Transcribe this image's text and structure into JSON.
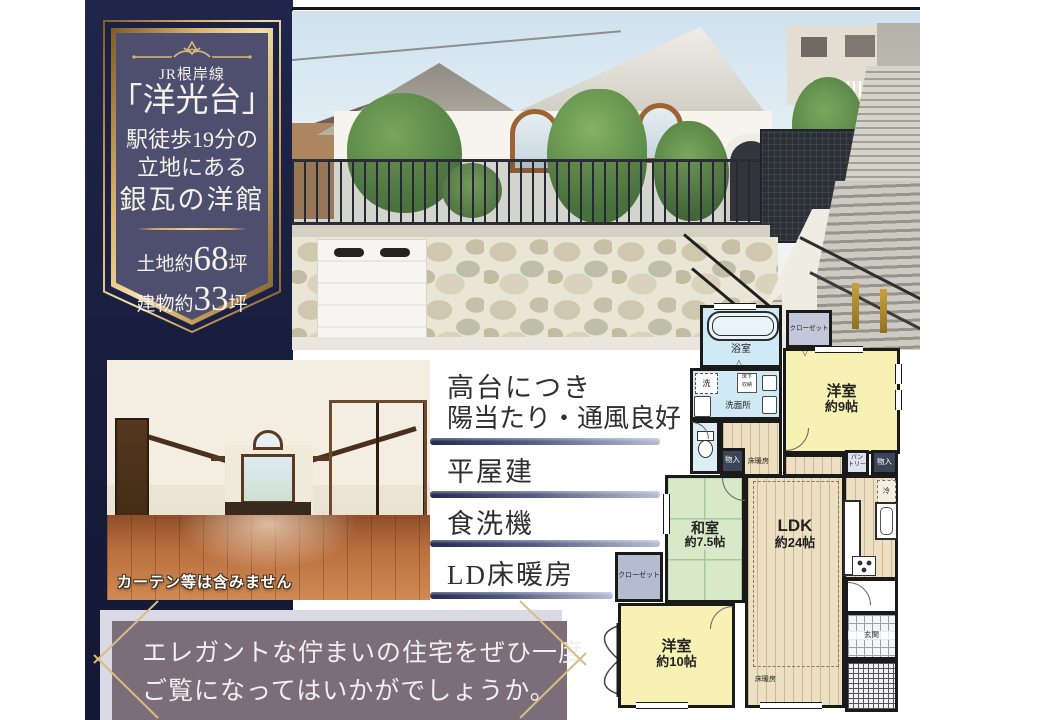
{
  "sidebar": {
    "rail": "JR根岸線",
    "station": "「洋光台」",
    "walk1": "駅徒歩19分の",
    "walk2": "立地にある",
    "catch": "銀瓦の洋館",
    "land_prefix": "土地約",
    "land_value": "68",
    "land_unit": "坪",
    "bldg_prefix": "建物約",
    "bldg_value": "33",
    "bldg_unit": "坪"
  },
  "features": {
    "item1_line1": "高台につき",
    "item1_line2": "陽当たり・通風良好",
    "item2": "平屋建",
    "item3": "食洗機",
    "item4": "LD床暖房"
  },
  "interior": {
    "caption": "カーテン等は含みません"
  },
  "message": {
    "line1": "エレガントな佇まいの住宅をぜひ一度",
    "line2": "ご覧になってはいかがでしょうか。"
  },
  "plan": {
    "bath": "浴室",
    "closet_top": "クローゼット",
    "west9_name": "洋室",
    "west9_size": "約9帖",
    "washroom": "洗面所",
    "washer": "洗",
    "underfloor1": "床下",
    "underfloor2": "収納",
    "storage_left": "物入",
    "storage_right": "物入",
    "pantry1": "パン",
    "pantry2": "トリー",
    "fridge": "冷",
    "ldk_name": "LDK",
    "ldk_size": "約24帖",
    "heating_top": "床暖房",
    "heating_bottom": "床暖房",
    "tatami_name": "和室",
    "tatami_size": "約7.5帖",
    "closet_left": "クローゼット",
    "west10_name": "洋室",
    "west10_size": "約10帖",
    "entrance": "玄関",
    "mark_down": "▽",
    "mark_up": "△"
  },
  "colors": {
    "navy": "#1b2145",
    "gold": "#c9a45f",
    "mauve": "#7b6e79",
    "room_yellow": "#f7f1b4",
    "room_green": "#d8e9c8",
    "room_blue": "#cfe9f5"
  }
}
